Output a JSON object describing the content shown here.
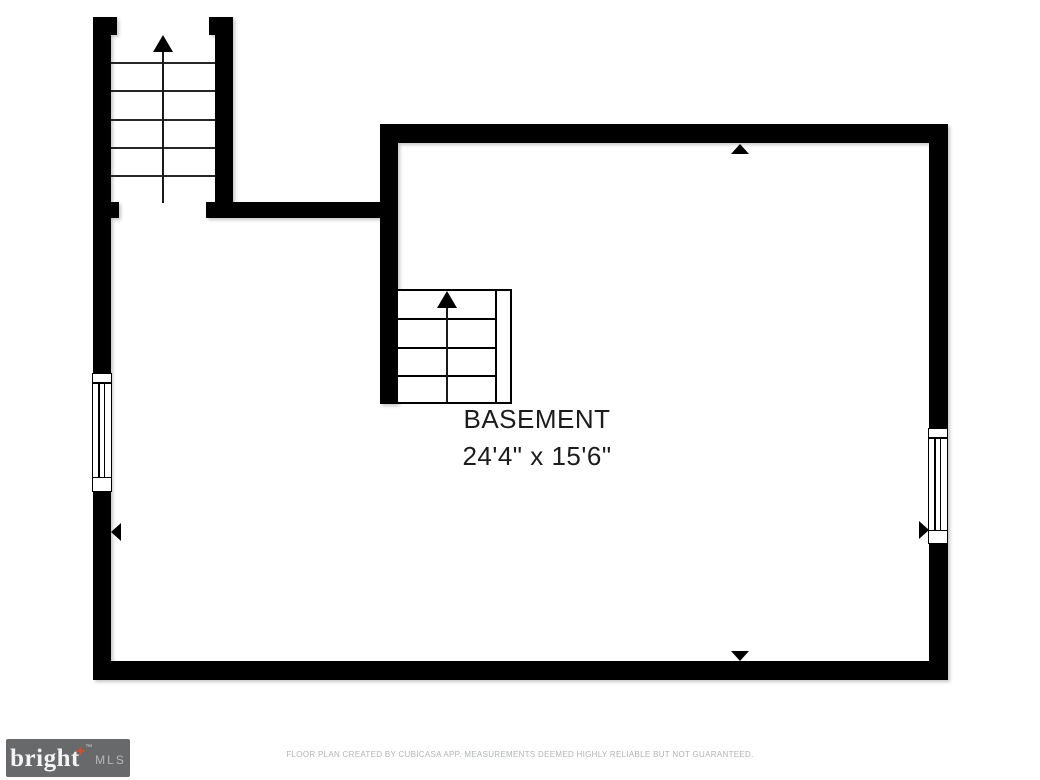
{
  "floor_plan": {
    "room_label": "BASEMENT",
    "room_dimensions": "24'4\" x 15'6\"",
    "icons": {
      "stairs_up_arrow": "▲",
      "measure_arrow_up": "▲",
      "measure_arrow_down": "▼",
      "measure_arrow_left": "◄",
      "measure_arrow_right": "►",
      "window": "double-line window symbol"
    }
  },
  "footer": {
    "brand": {
      "name": "bright",
      "plus": "+",
      "tm": "™",
      "suffix": "MLS"
    },
    "disclaimer": "FLOOR PLAN CREATED BY CUBICASA APP. MEASUREMENTS DEEMED HIGHLY RELIABLE BUT NOT GUARANTEED."
  },
  "colors": {
    "background": "#ffffff",
    "wall": "#000000",
    "text": "#1c1c1c",
    "brand_bg": "#68696b",
    "brand_text": "#f4f4f4",
    "brand_accent": "#d4502c",
    "brand_mls": "#b5b7b9",
    "disclaimer_text": "#b0b3b5"
  }
}
